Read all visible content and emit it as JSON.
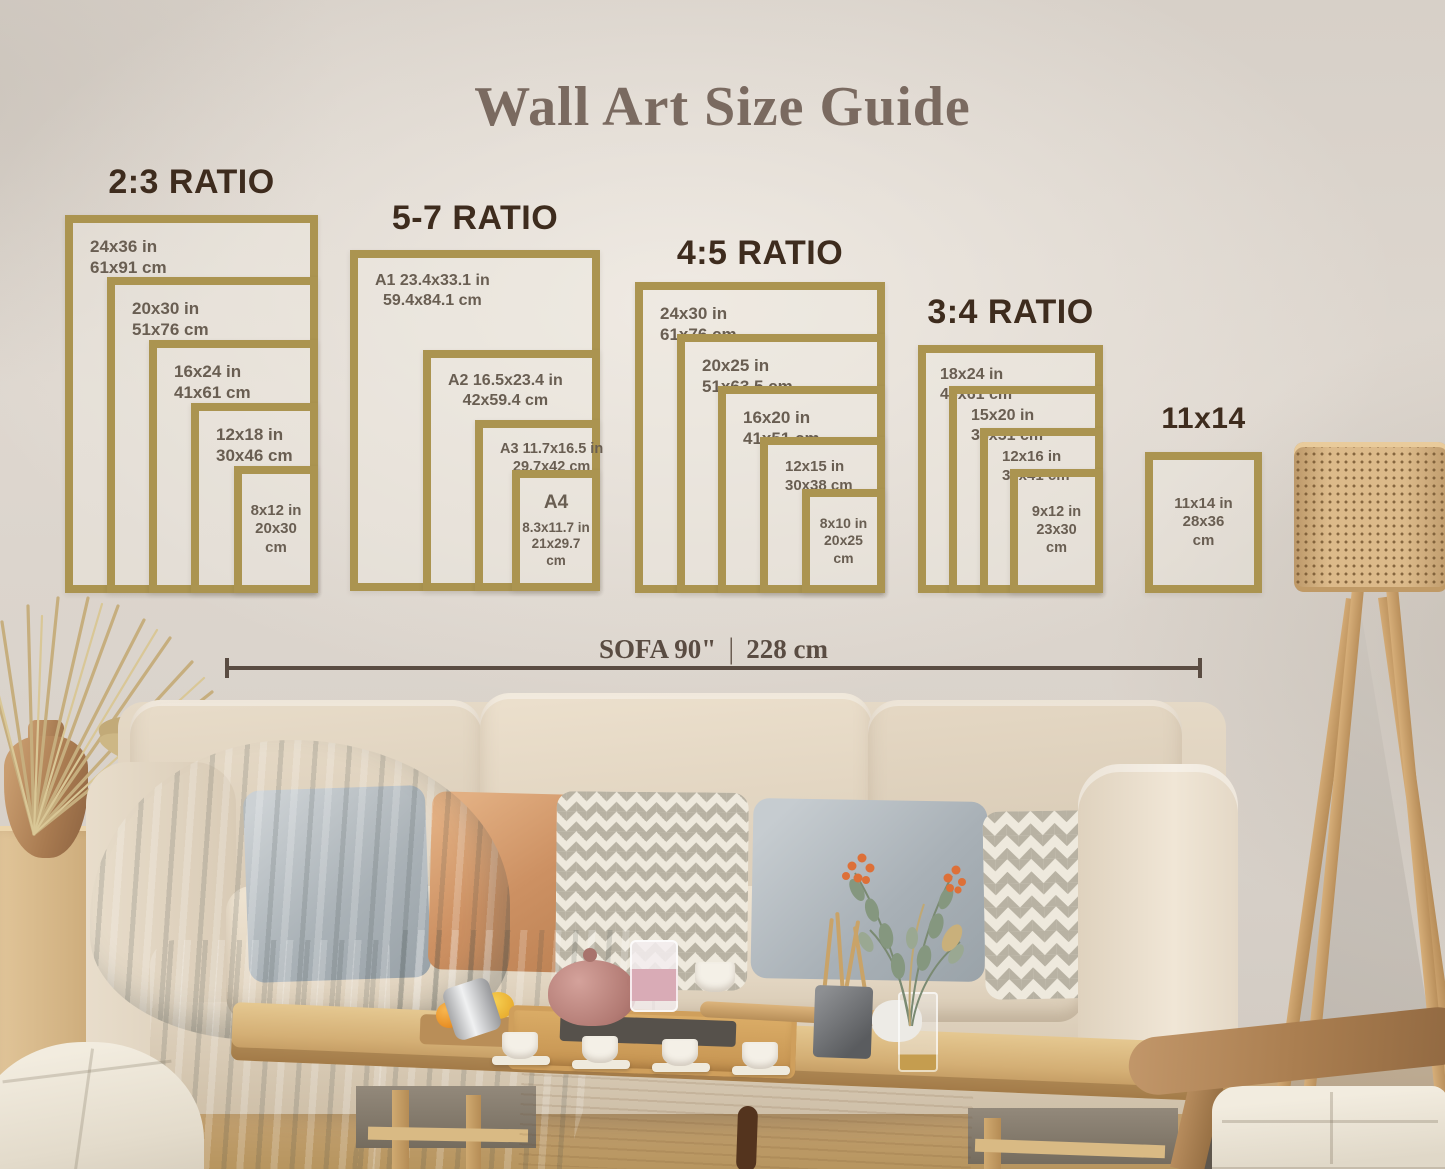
{
  "title": "Wall Art Size Guide",
  "measure": {
    "sofa_in": "SOFA 90\"",
    "separator": "|",
    "sofa_cm": "228 cm"
  },
  "groups": [
    {
      "heading": "2:3 RATIO",
      "frames": [
        {
          "lines": [
            "24x36 in",
            "61x91 cm"
          ]
        },
        {
          "lines": [
            "20x30 in",
            "51x76 cm"
          ]
        },
        {
          "lines": [
            "16x24 in",
            "41x61 cm"
          ]
        },
        {
          "lines": [
            "12x18 in",
            "30x46 cm"
          ]
        },
        {
          "lines": [
            "8x12 in",
            "20x30",
            "cm"
          ]
        }
      ]
    },
    {
      "heading": "5-7 RATIO",
      "frames": [
        {
          "lines": [
            "A1 23.4x33.1 in",
            "59.4x84.1 cm"
          ]
        },
        {
          "lines": [
            "A2 16.5x23.4 in",
            "42x59.4 cm"
          ]
        },
        {
          "lines": [
            "A3 11.7x16.5 in",
            "29.7x42 cm"
          ]
        },
        {
          "lines": [
            "A4",
            "8.3x11.7 in",
            "21x29.7",
            "cm"
          ]
        }
      ]
    },
    {
      "heading": "4:5 RATIO",
      "frames": [
        {
          "lines": [
            "24x30 in",
            "61x76 cm"
          ]
        },
        {
          "lines": [
            "20x25 in",
            "51x63.5 cm"
          ]
        },
        {
          "lines": [
            "16x20 in",
            "41x51 cm"
          ]
        },
        {
          "lines": [
            "12x15 in",
            "30x38 cm"
          ]
        },
        {
          "lines": [
            "8x10 in",
            "20x25",
            "cm"
          ]
        }
      ]
    },
    {
      "heading": "3:4 RATIO",
      "frames": [
        {
          "lines": [
            "18x24 in",
            "46x61 cm"
          ]
        },
        {
          "lines": [
            "15x20 in",
            "38x51 cm"
          ]
        },
        {
          "lines": [
            "12x16 in",
            "30x41 cm"
          ]
        },
        {
          "lines": [
            "9x12 in",
            "23x30",
            "cm"
          ]
        }
      ]
    },
    {
      "heading": "11x14",
      "frames": [
        {
          "lines": [
            "11x14 in",
            "28x36",
            "cm"
          ]
        }
      ]
    }
  ],
  "colors": {
    "frame_gold": "#ab9450",
    "heading_brown": "#3e2c1e",
    "label_brown": "#695e52",
    "title_taupe": "#7a6a60",
    "measure_line": "#5a4c42"
  }
}
